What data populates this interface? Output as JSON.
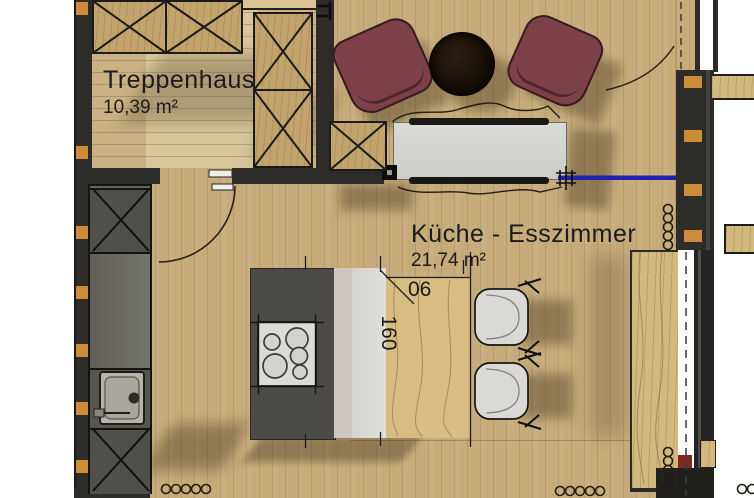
{
  "plan": {
    "type": "floor-plan",
    "rooms": [
      {
        "id": "treppenhaus",
        "name": "Treppenhaus",
        "area": "10,39 m²"
      },
      {
        "id": "kueche_esszimmer",
        "name": "Küche - Esszimmer",
        "area": "21,74 m²"
      }
    ],
    "dimensions": {
      "table_width": "06",
      "table_length": "160"
    },
    "furniture": [
      "stair-treads",
      "wardrobe-x-cabinet",
      "tall-x-cabinet",
      "side-x-cabinet",
      "armchair-left",
      "armchair-right",
      "round-coffee-table",
      "sideboard",
      "kitchen-counter",
      "appliance-top",
      "appliance-bottom",
      "sink",
      "kitchen-island",
      "cooktop",
      "dining-table",
      "dining-chair-1",
      "dining-chair-2",
      "sliding-wood-panel",
      "window-glass",
      "door-swing",
      "balcony-door-swing",
      "insulation-spirals",
      "section-line-blue"
    ]
  },
  "colors": {
    "floor": "#c7ab7a",
    "floor_light": "#d9c69a",
    "trep_floor": "#cbb184",
    "wall": "#2e2c29",
    "stud": "#cd8d38",
    "wood": "#c2a46c",
    "wood_light": "#d4b97f",
    "island": "#4c4b47",
    "counter": "#64635c",
    "cooktop": "#dcdbd5",
    "sink": "#b5b3aa",
    "sideboard": "#d6d5d2",
    "chair_maroon": "#7b4048",
    "chair_maroon_dark": "#371b21",
    "table_black": "#171007",
    "chair_white": "#dad9d5",
    "table_wood": "#d8bc82",
    "strip_pink": "#cec6c1",
    "strip_light": "#e0ded8",
    "glass": "#fbfbf9",
    "frame": "#262523",
    "blue": "#2023ac",
    "red_block": "#7d2b20",
    "shadow": "rgba(66,48,24,0.40)",
    "text": "#1b1b1b"
  }
}
